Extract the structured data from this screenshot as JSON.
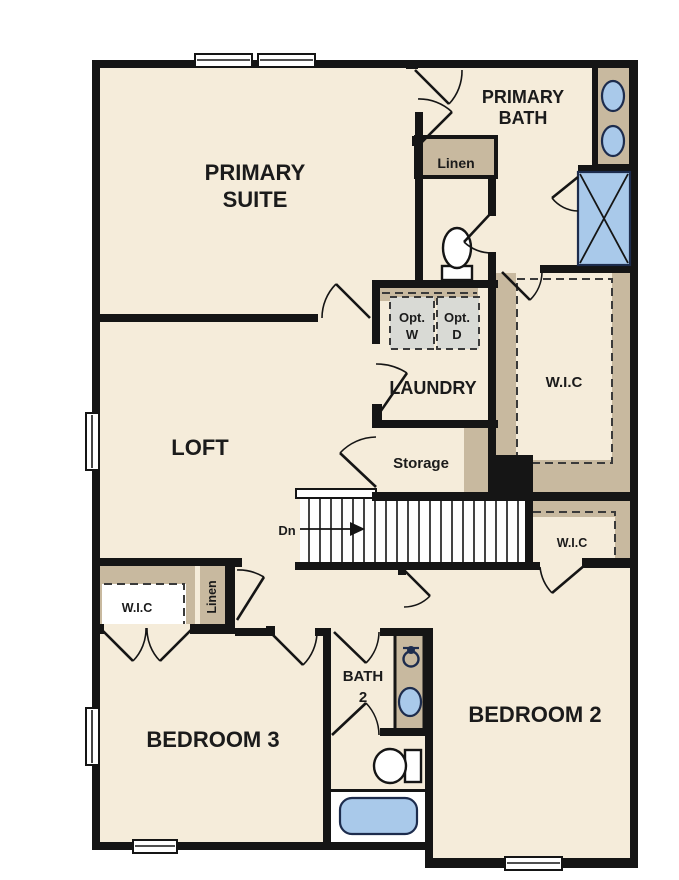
{
  "rooms": {
    "primary_suite": {
      "line1": "PRIMARY",
      "line2": "SUITE"
    },
    "primary_bath": {
      "line1": "PRIMARY",
      "line2": "BATH"
    },
    "loft": "LOFT",
    "laundry": "LAUNDRY",
    "storage": "Storage",
    "bedroom2": "BEDROOM 2",
    "bedroom3": "BEDROOM 3",
    "bath2": {
      "line1": "BATH",
      "line2": "2"
    },
    "wic_primary": "W.I.C",
    "wic_hall": "W.I.C",
    "wic_bedroom3": "W.I.C"
  },
  "closets": {
    "linen_bath": "Linen",
    "linen_hall": "Linen"
  },
  "stairs": {
    "direction": "Dn"
  },
  "appliances": {
    "washer": {
      "line1": "Opt.",
      "line2": "W"
    },
    "dryer": {
      "line1": "Opt.",
      "line2": "D"
    }
  },
  "colors": {
    "floor": "#f5ecda",
    "wall": "#151515",
    "tan": "#c8b99f",
    "fixture-blue": "#a9c9ea",
    "fixture-stroke": "#1d2c4d",
    "appliance-gray": "#d9dad5",
    "dash": "#3a3a3a"
  }
}
